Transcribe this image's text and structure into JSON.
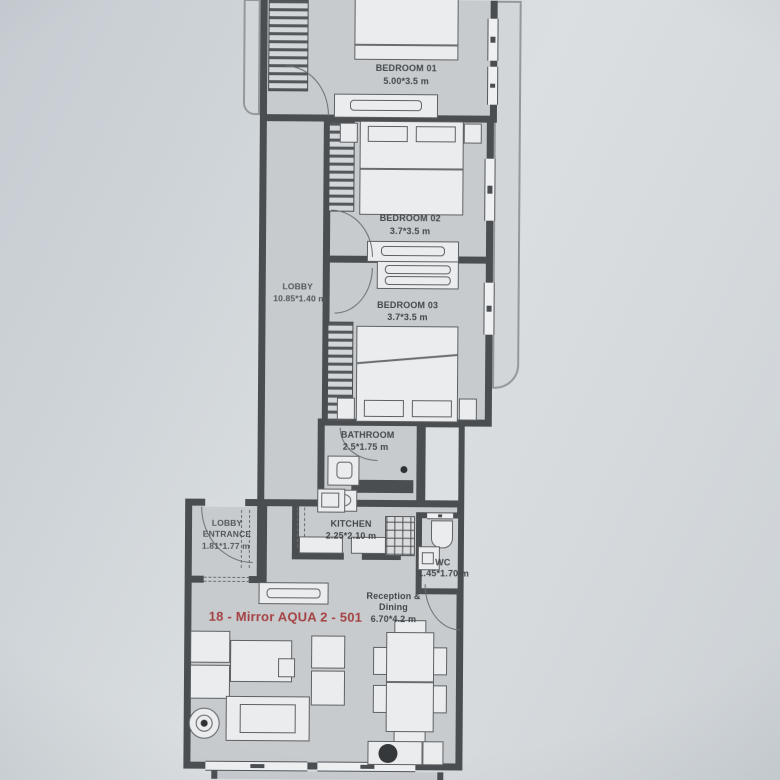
{
  "unit_label": "18 - Mirror AQUA 2 - 501",
  "colors": {
    "paper": "#d7dbde",
    "room": "#c7cbce",
    "wall": "#4b4e51",
    "furniture": "#eaeced",
    "balcony": "#d2d6d9",
    "dashline": "#6b6e71",
    "unit_red": "#a54243",
    "label_text": "#43474b"
  },
  "rooms": [
    {
      "id": "bedroom-01",
      "name": "BEDROOM 01",
      "dims": "5.00*3.5 m"
    },
    {
      "id": "bedroom-02",
      "name": "BEDROOM 02",
      "dims": "3.7*3.5 m"
    },
    {
      "id": "bedroom-03",
      "name": "BEDROOM 03",
      "dims": "3.7*3.5 m"
    },
    {
      "id": "lobby",
      "name": "LOBBY",
      "dims": "10.85*1.40 m"
    },
    {
      "id": "bathroom",
      "name": "BATHROOM",
      "dims": "2.5*1.75 m"
    },
    {
      "id": "kitchen",
      "name": "KITCHEN",
      "dims": "2.25*2.10 m"
    },
    {
      "id": "lobby-entrance",
      "name_line1": "LOBBY",
      "name_line2": "ENTRANCE",
      "dims": "1.81*1.77 m"
    },
    {
      "id": "wc",
      "name": "WC",
      "dims": "1.45*1.70 m"
    },
    {
      "id": "reception-dining",
      "name_line1": "Reception &",
      "name_line2": "Dining",
      "dims": "6.70*4.2 m"
    }
  ]
}
